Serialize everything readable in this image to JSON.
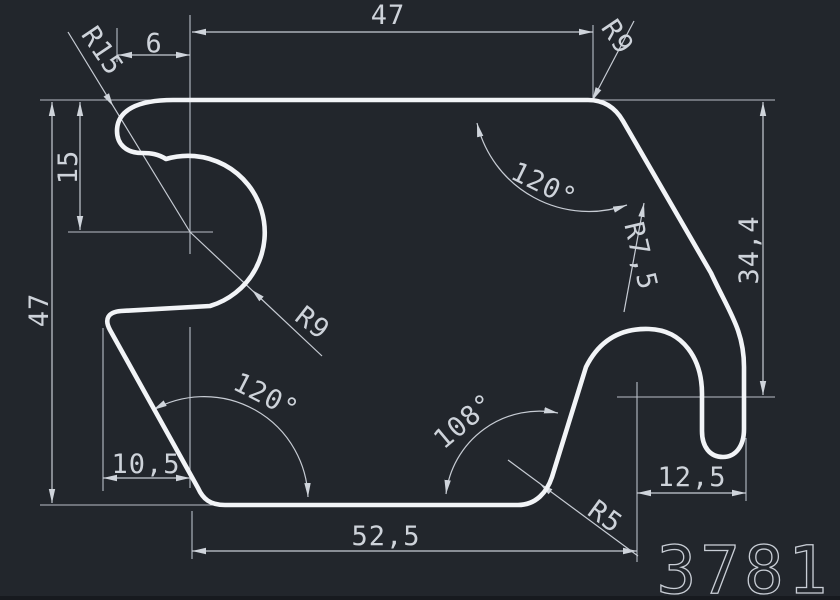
{
  "title": "Extrusion profile cross-section drawing",
  "part_number": "3781",
  "dims": {
    "top_width": "47",
    "top_left_offset": "9",
    "left_height": "47",
    "left_upper_height": "15",
    "right_height": "34,4",
    "bottom_width": "52,5",
    "bottom_left_width": "10,5",
    "bottom_right_width": "12,5"
  },
  "angles": {
    "top_right": "120°",
    "bottom_left": "120°",
    "bottom_right": "108°"
  },
  "radii": {
    "top_left": "R15",
    "top_right": "R9",
    "middle": "R9",
    "right": "R7,5",
    "bottom_right": "R5"
  },
  "colors": {
    "background": "#22262c",
    "profile_line": "#f2f4f7",
    "dimension_line": "#c7ccd4",
    "text": "#ced3da"
  }
}
